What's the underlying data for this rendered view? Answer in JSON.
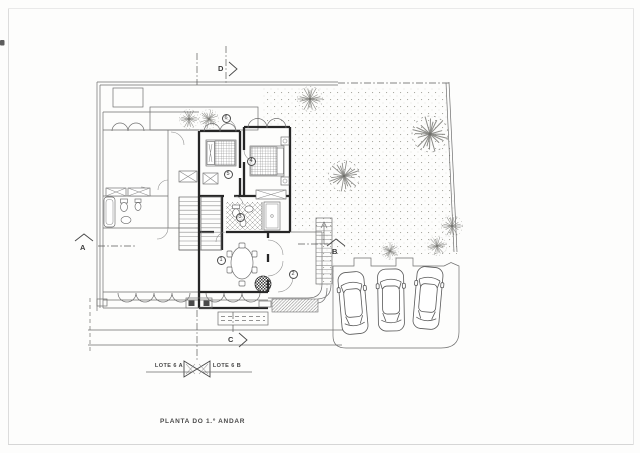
{
  "drawing": {
    "caption": "PLANTA DO 1.º ANDAR",
    "lots": {
      "left": "LOTE 6 A",
      "right": "LOTE 6 B"
    },
    "section_markers": {
      "a": "A",
      "b": "B",
      "c": "C",
      "d": "D"
    },
    "room_numbers": {
      "n1": "1",
      "n2": "2",
      "n3": "3",
      "n4": "4",
      "n5": "5",
      "n6": "6"
    },
    "colors": {
      "paper": "#fdfdfc",
      "thin_line": "#6e6e6e",
      "thick_wall": "#262626",
      "stipple": "#98988f",
      "tree": "#8b8b87"
    }
  }
}
